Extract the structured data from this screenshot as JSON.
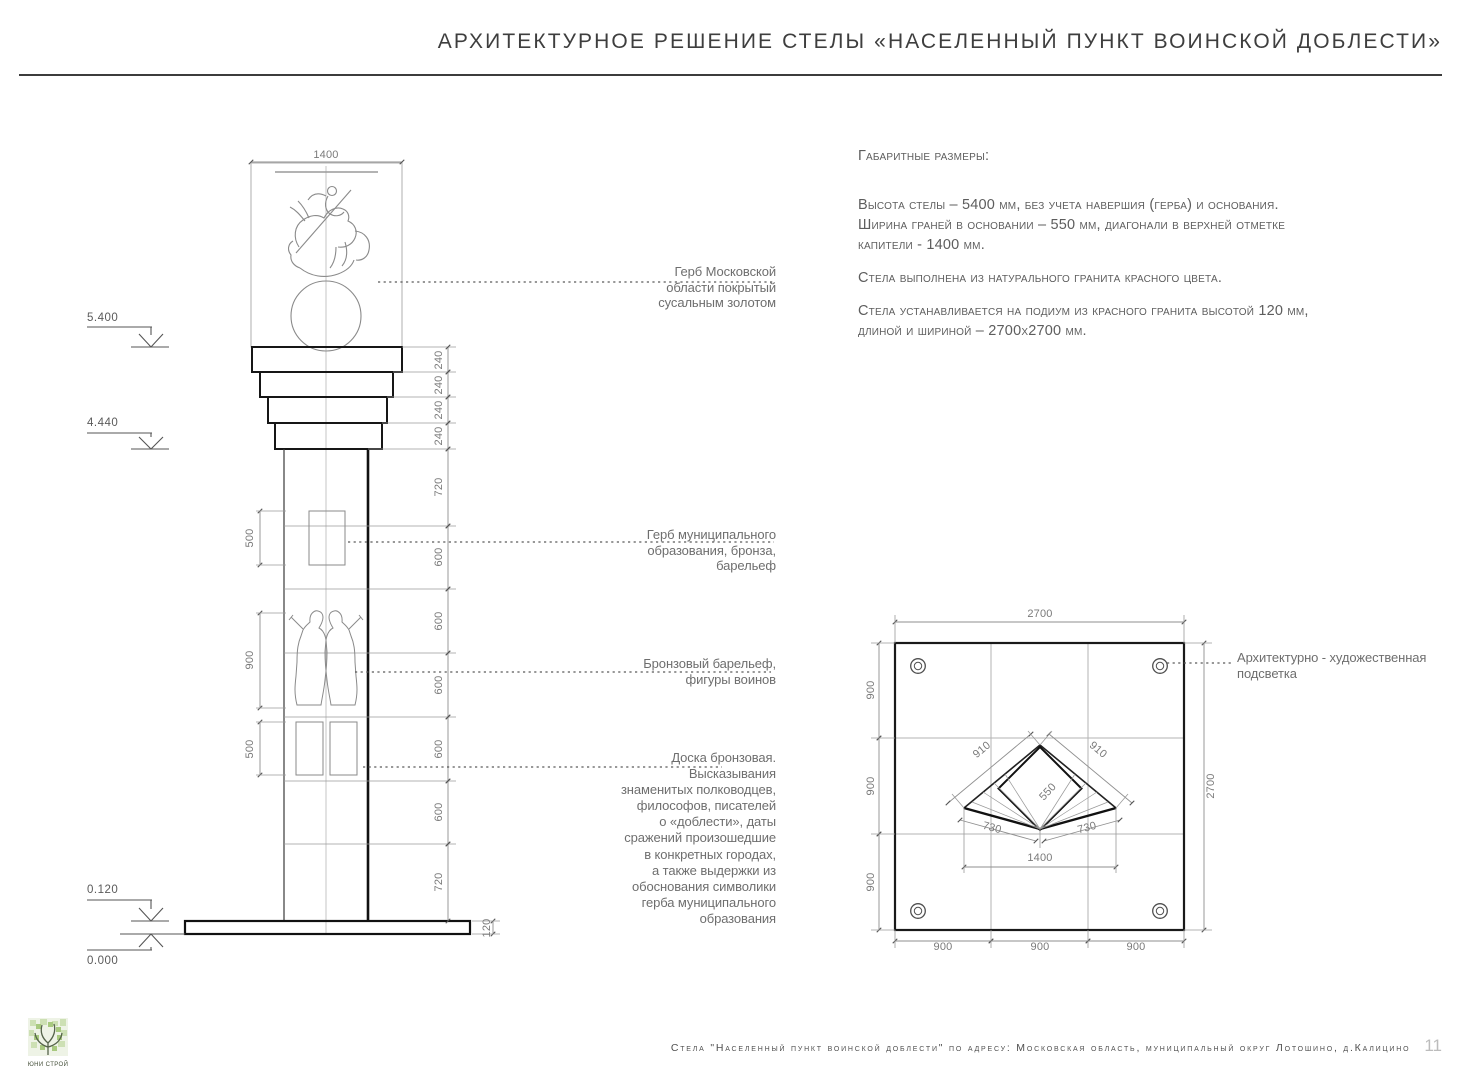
{
  "title": "АРХИТЕКТУРНОЕ РЕШЕНИЕ СТЕЛЫ «НАСЕЛЕННЫЙ ПУНКТ ВОИНСКОЙ ДОБЛЕСТИ»",
  "specs": {
    "heading": "Габаритные размеры:",
    "p1": [
      "Высота стелы – 5400 мм, без учета навершия (герба) и основания.",
      "Ширина граней в основании – 550 мм, диагонали в верхней отметке",
      "капители - 1400 мм."
    ],
    "p2": [
      "Стела выполнена из натурального гранита красного цвета."
    ],
    "p3": [
      "Стела устанавливается на подиум из красного гранита высотой 120 мм,",
      "длиной и шириной – 2700х2700 мм."
    ]
  },
  "annotations": {
    "emblem_moscow": [
      "Герб Московской",
      "области покрытый",
      "сусальным золотом"
    ],
    "emblem_municipal": [
      "Герб муниципального",
      "образования, бронза,",
      "барельеф"
    ],
    "bas_relief": [
      "Бронзовый барельеф,",
      "фигуры воинов"
    ],
    "plaque": [
      "Доска бронзовая.",
      "Высказывания",
      "знаменитых полководцев,",
      "философов, писателей",
      "о «доблести», даты",
      "сражений произошедшие",
      "в конкретных городах,",
      "а также выдержки из",
      "обоснования символики",
      "герба муниципального",
      "образования"
    ],
    "lighting": [
      "Архитектурно - художественная",
      "подсветка"
    ]
  },
  "elevation": {
    "top_width": "1400",
    "capital_steps": [
      "240",
      "240",
      "240",
      "240"
    ],
    "shaft_segments": [
      "720",
      "600",
      "600",
      "600",
      "600",
      "600",
      "720"
    ],
    "podium_height": "120",
    "relief_heights": [
      "500",
      "900",
      "500"
    ],
    "levels": {
      "top": "5.400",
      "capital_base": "4.440",
      "podium": "0.120",
      "ground": "0.000"
    }
  },
  "plan": {
    "width": "2700",
    "height": "2700",
    "left": [
      "900",
      "900",
      "900"
    ],
    "bottom": [
      "900",
      "900",
      "900"
    ],
    "upper_edges": [
      "910",
      "910"
    ],
    "core": "550",
    "lower_edges": [
      "730",
      "730"
    ],
    "base_width": "1400"
  },
  "footer": {
    "project": "Стела \"Населенный пункт воинской доблести\" по адресу: Московская область, муниципальный округ Лотошино, д.Калицино",
    "page": "11"
  },
  "logo": {
    "company": "ЮНИ СТРОЙ"
  },
  "colors": {
    "line_bold": "#111111",
    "line_thin": "#8a8a8a",
    "dim": "#8f8f8f",
    "accent_logo": "#a8c97f"
  }
}
